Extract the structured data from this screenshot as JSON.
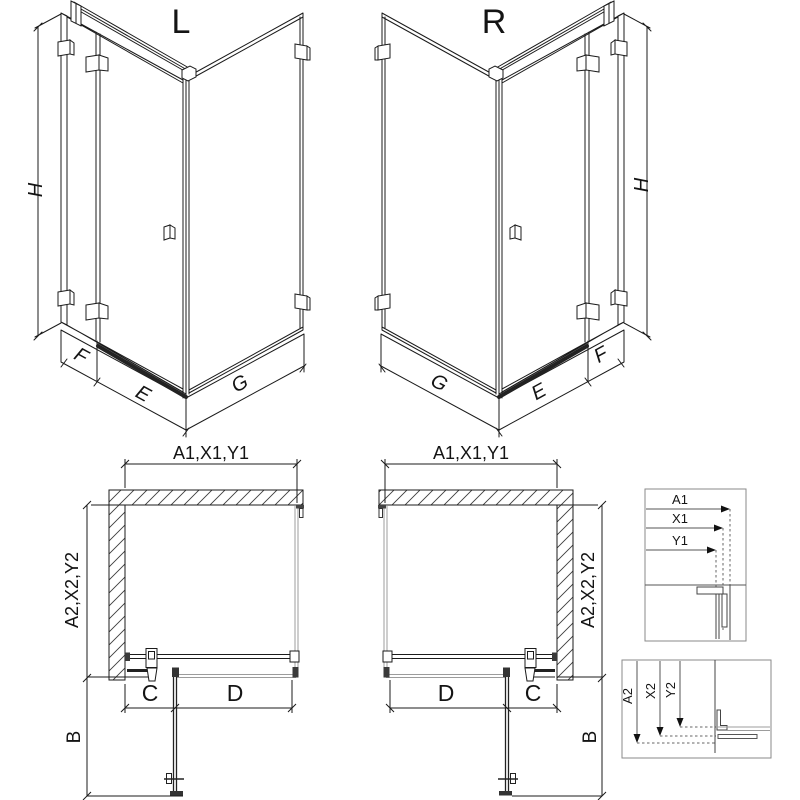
{
  "colors": {
    "line": "#1b1b1b",
    "glass_gray": "#9c9c9c",
    "dark_profile": "#2e2e2e",
    "detail_border": "#8a8a8a",
    "background": "#ffffff"
  },
  "iso_views": {
    "left": {
      "label": "L",
      "height_dim": "H",
      "fixed_panel_dim": "F",
      "door_dim": "E",
      "side_panel_dim": "G"
    },
    "right": {
      "label": "R",
      "height_dim": "H",
      "fixed_panel_dim": "F",
      "door_dim": "E",
      "side_panel_dim": "G"
    }
  },
  "plan_views": {
    "left": {
      "width_dim": "A1,X1,Y1",
      "depth_dim": "A2,X2,Y2",
      "fixed_width_dim": "C",
      "door_width_dim": "D",
      "door_swing_dim": "B"
    },
    "right": {
      "width_dim": "A1,X1,Y1",
      "depth_dim": "A2,X2,Y2",
      "fixed_width_dim": "C",
      "door_width_dim": "D",
      "door_swing_dim": "B"
    }
  },
  "detail_boxes": {
    "width_profile": {
      "labels": [
        "A1",
        "X1",
        "Y1"
      ]
    },
    "depth_profile": {
      "labels": [
        "A2",
        "X2",
        "Y2"
      ]
    }
  }
}
